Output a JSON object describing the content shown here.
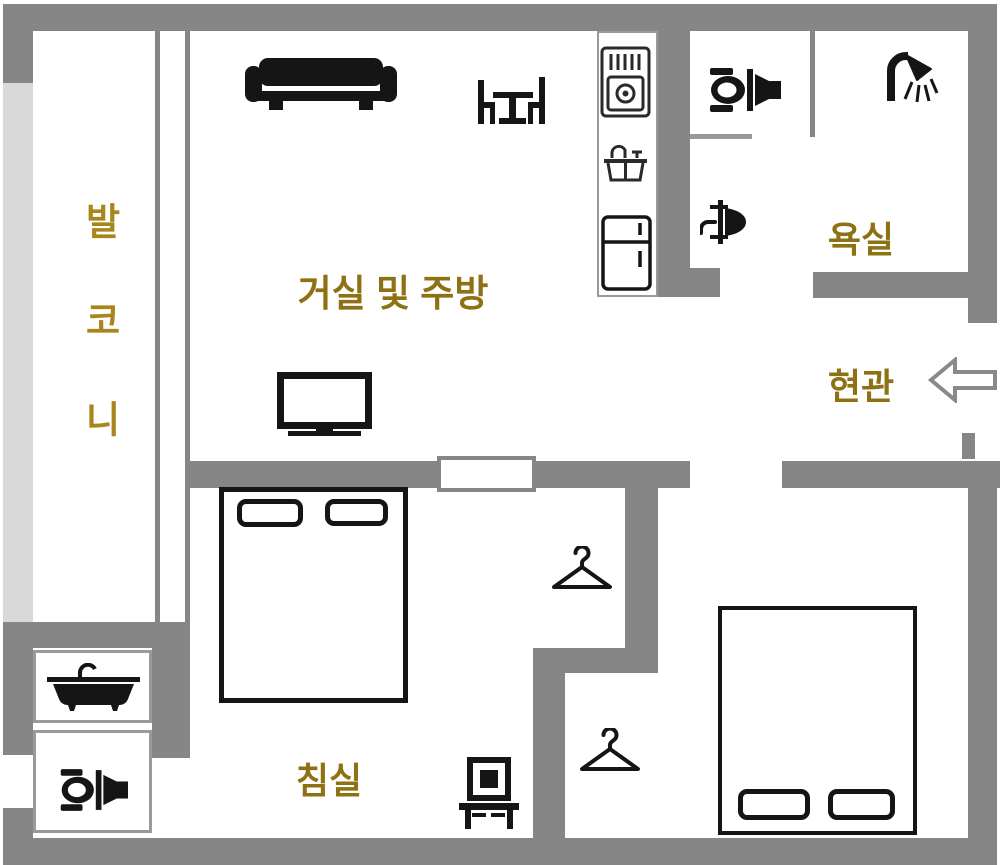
{
  "rooms": {
    "balcony": {
      "label": "발코니"
    },
    "living_kitchen": {
      "label": "거실 및 주방"
    },
    "bathroom": {
      "label": "욕실"
    },
    "entrance": {
      "label": "현관"
    },
    "bedroom": {
      "label": "침실"
    }
  },
  "colors": {
    "wall": "#868686",
    "window_glass": "#d9d9d9",
    "room_label": "#8e7113",
    "balcony_label": "#a8861c",
    "furniture_black": "#151515"
  },
  "icons": {
    "sofa-icon": "sofa",
    "dining-set-icon": "table with two chairs",
    "tv-icon": "television",
    "stove-icon": "gas range",
    "kitchen-sink-icon": "kitchen sink",
    "refrigerator-icon": "refrigerator",
    "toilet-icon-bathroom": "toilet",
    "washbasin-icon": "washbasin",
    "shower-icon": "shower head",
    "bathtub-icon": "bathtub",
    "toilet-icon-wc": "toilet",
    "hanger-icon-closet-1": "clothes hanger",
    "hanger-icon-closet-2": "clothes hanger",
    "dressing-table-icon": "dressing table",
    "entrance-arrow-icon": "left arrow entry direction"
  }
}
